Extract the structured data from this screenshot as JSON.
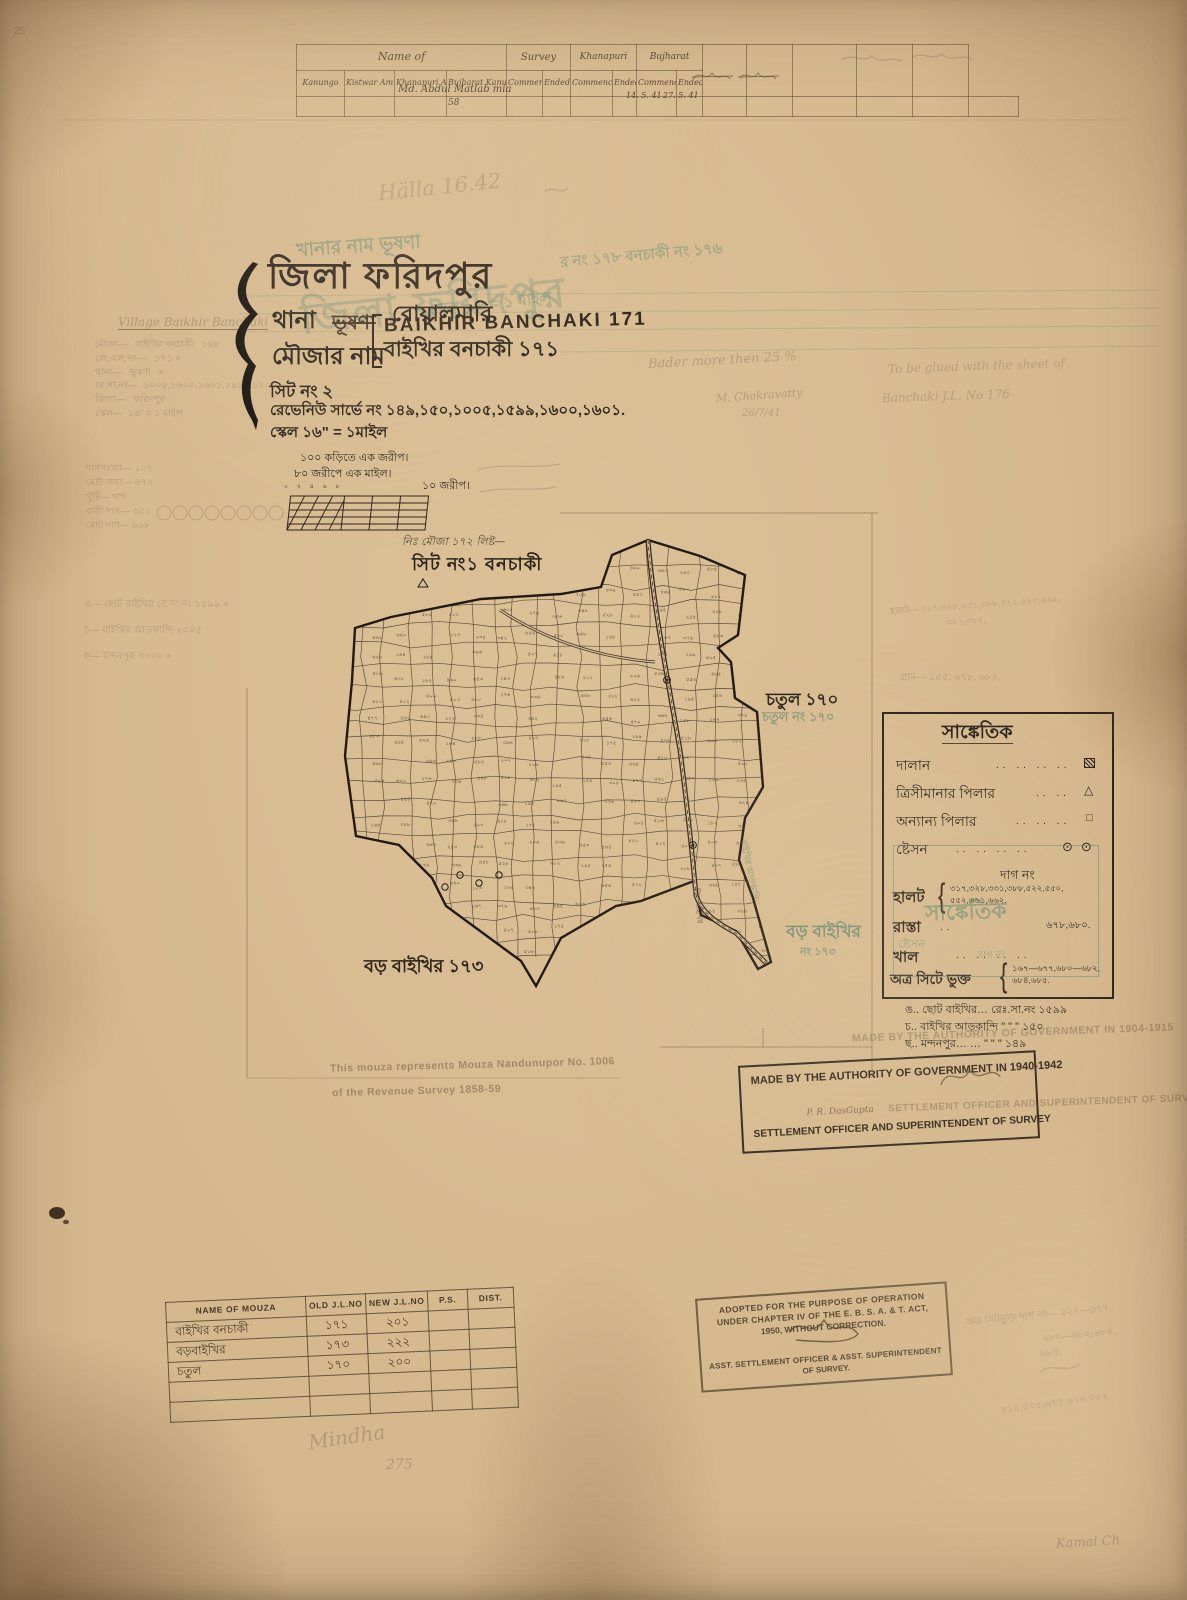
{
  "annotations": {
    "corner_25": "25",
    "halla": "Hälla 16.42",
    "bader": "Bader more then 25 %",
    "bader_sig": "M. Chakravatty",
    "bader_date": "26/7/41",
    "glued1": "To be glued with the sheet of",
    "glued2": "Banchaki J.L. No 176",
    "right_mid1": "হালট— ২২৭,৩২৮,৩৩১,৩৮৮,৫২২,৫৫০,৬৬২,",
    "right_mid2": "৩৮১,৩৮২,",
    "right_mid3": "গ্রাম— ১৫৫, ৬৭৮, ৬৮০,",
    "br1": "অত্র সিটভুক্ত দাগ নং— ২২৭—৬৭৭,",
    "br2": "৬৮০—৬৮২,৬৮৪,",
    "br3": "৬৮৫,",
    "br4": "৫১৪,৫৩৫,৬৭৫,৬১৬,৩৪২",
    "mindha": "Mindha",
    "mindha_no": "275",
    "kamal": "Kamal Ch"
  },
  "top_table": {
    "group1": "Name of",
    "group2": "Survey",
    "group3": "Khanapuri",
    "group4": "Bujharat",
    "columns": [
      "Kanungo",
      "Kistwar Amin",
      "Khanapuri Amin",
      "Bujharat Kanungo",
      "Commenced",
      "Ended",
      "Commenced",
      "Ended",
      "Commenced",
      "Ended"
    ],
    "entry_name": "Md. Abdul Matlab mia",
    "entry_no": "58",
    "bujharat_commenced": "14. 5. 41",
    "bujharat_ended": "27. 5. 41"
  },
  "title_block": {
    "district": "জিলা ফরিদপুর",
    "thana_label": "থানা",
    "thana_struck": "ভূষণা",
    "thana_value": "বোয়ালমারি",
    "mouza_label": "মৌজার নাম",
    "mouza_stamp_en": "BAIKHIR BANCHAKI 171",
    "mouza_value_bn": "বাইখির বনচাকী ১৭১",
    "sheet_no": "সিট নং ২",
    "revenue_survey": "রেভেনিউ সার্ভে নং ১৪৯,১৫০,১০০৫,১৫৯৯,১৬০০,১৬০১.",
    "scale": "স্কেল ১৬\" = ১মাইল"
  },
  "green_ghost": {
    "line_top": "খানার নাম ভূষণা",
    "title": "জিলা ফরিদপুর",
    "right": "র নং ১৭৮   বনচাকী   নং ১৭৬",
    "scale": "স্কেল ১৬ = ১ মাইল"
  },
  "left_margin": {
    "village_en": "Village    Baikhir Banchaki",
    "lines": [
      "মৌজা—   বাইখির বনচাকী   ১৬৮",
      "জে.এল.নং—   ১৭১ ×",
      "থানা—   ভূষণা   ×",
      "রে.সা.নং—  ১০০৫,১৬০০,১৬০১,১৫৯৯,১৫০০",
      "জিলা—   ফরিদপুর",
      "স্কেল—  ১৬\" = ১ মাইল"
    ],
    "refs1": [
      "দাগসংখ্যা—   ১০৭",
      "মোট জমা—   ৬৭২",
      "খুঁটি—   দাগ",
      "বাড়ী দাগ—   ৩৩১",
      "মোট দাগ—   ৬৯৮"
    ],
    "refs2": [
      "ঙ— ছোট বাইথির   রে:সা:নং ১৫৯৯ ×",
      "চ— বাইথির আড়কান্দি    ২০০৫",
      "ছ— মন্দনপুর    ৩০০০ ×"
    ]
  },
  "scale_bar": {
    "line1": "১০০ কড়িতে এক জরীপ।",
    "line2": "৮০ জরীপে এক মাইল।",
    "right_label": "১০ জরীপ।",
    "ticks": [
      "০",
      "২",
      "৪",
      "৬",
      "৮"
    ]
  },
  "map": {
    "hand_note": "নিঃ মৌজা ১৭২ লিষ্ট—",
    "sheet_label": "সিট নং১  বনচাকী",
    "chatul": "চতুল ১৭০",
    "chatul_ghost": "চতুল নং ১৭০",
    "boro_green": "বড় বাইখির",
    "boro_green2": "নং ১৭৩",
    "boro_black": "বড় বাইখির ১৭৩",
    "road_label": "বাইখির আড়কান্দি",
    "bil_label": "বিল বাইখির",
    "plot_numbers": [
      "৪৬০",
      "৬৪৩",
      "২৪৩",
      "৫৮৪",
      "২০২",
      "২০৬",
      "৪৩৯",
      "৫৫৩",
      "৪৬৫",
      "৪২০",
      "৪১২",
      "৫০০",
      "৫০৩",
      "৬০০",
      "২৭৬",
      "৩৩৬",
      "৪৪৮",
      "৫২৮",
      "৬১২",
      "১৯৫",
      "২৫৪",
      "৩০৮",
      "৪৭৭",
      "৫৬১",
      "৬৪০",
      "১২৩",
      "২৩৫",
      "৩৪২",
      "৪৫৬",
      "৫৭০",
      "৬৬৮",
      "১৪৮",
      "২৬৭",
      "৩৭৯",
      "৪৮৩",
      "৫৯৫",
      "৬২৪",
      "১৬৪",
      "২৮৮",
      "৩৯৬",
      "৫০৭",
      "৬১৮",
      "১৭৫",
      "২৯৯",
      "৪০৫",
      "৫১৬",
      "৬৩০",
      "১৮২"
    ]
  },
  "legend": {
    "title": "সাঙ্কেতিক",
    "rows": [
      {
        "label": "দালান"
      },
      {
        "label": "ত্রিসীমানার পিলার"
      },
      {
        "label": "অন্যান্য পিলার"
      },
      {
        "label": "ষ্টেসন"
      }
    ],
    "dag_no": "দাগ নং",
    "halot_label": "হালট",
    "halot_values1": "৩১৭,৩২৮,৩৩১,৩৮৮,৫২২,৫৫০,",
    "halot_values2": "৫৫২,৬৬১,৬৬২.",
    "rasta_label": "রাস্তা",
    "rasta_values": "৬৭৮,৬৮০.",
    "khal_label": "খাল",
    "atro_label": "অত্র সিটে ভুক্ত",
    "atro_values1": "১৬৭—৬৭৭,৬৮০—৬৮২,",
    "atro_values2": "৬৮৪,৬৮৫.",
    "ghost_title": "সাঙ্কেতিক",
    "ghost_steshon": "ষ্টেসন",
    "ghost_dag": "দাগ নং"
  },
  "legend_refs": [
    "ঙ..  ছোট বাইখির…    রেঃ.সা.নং ১৫৯৯",
    "চ..  বাইখির আড়কান্দি   \"   \"  \" ১৫০",
    "ছ..  মন্দনপুর…   …   \"   \"  \"  ১৪৯"
  ],
  "stamps": {
    "authority_line1": "MADE BY THE AUTHORITY OF GOVERNMENT IN 1940-1942",
    "authority_sig": "P. R. DasGupta",
    "authority_line2": "SETTLEMENT OFFICER AND SUPERINTENDENT OF  SURVEY",
    "ghost_line1": "MADE BY THE AUTHORITY OF GOVERNMENT IN 1904-1915",
    "ghost_line2": "SETTLEMENT OFFICER AND SUPERINTENDENT OF SURVEY",
    "revenue_note1": "This mouza represents Mouza Nandunupor No. 1006",
    "revenue_note2": "of the Revenue Survey  1858-59",
    "adopted_line1": "ADOPTED FOR THE PURPOSE OF OPERATION",
    "adopted_line2": "UNDER CHAPTER IV OF THE E. B. S. A. & T. ACT,",
    "adopted_line3": "1950, WITHOUT CORRECTION.",
    "adopted_line4": "ASST. SETTLEMENT OFFICER & ASST. SUPERINTENDENT",
    "adopted_line5": "OF SURVEY."
  },
  "bottom_table": {
    "headers": [
      "NAME OF MOUZA",
      "OLD J.L.NO",
      "NEW J.L.NO",
      "P.S.",
      "DIST."
    ],
    "rows": [
      {
        "name": "বাইখির বনচাকী",
        "old": "১৭১",
        "new": "২০১"
      },
      {
        "name": "বড়বাইখির",
        "old": "১৭৩",
        "new": "২২২"
      },
      {
        "name": "চতুল",
        "old": "১৭০",
        "new": "২০০"
      }
    ]
  }
}
